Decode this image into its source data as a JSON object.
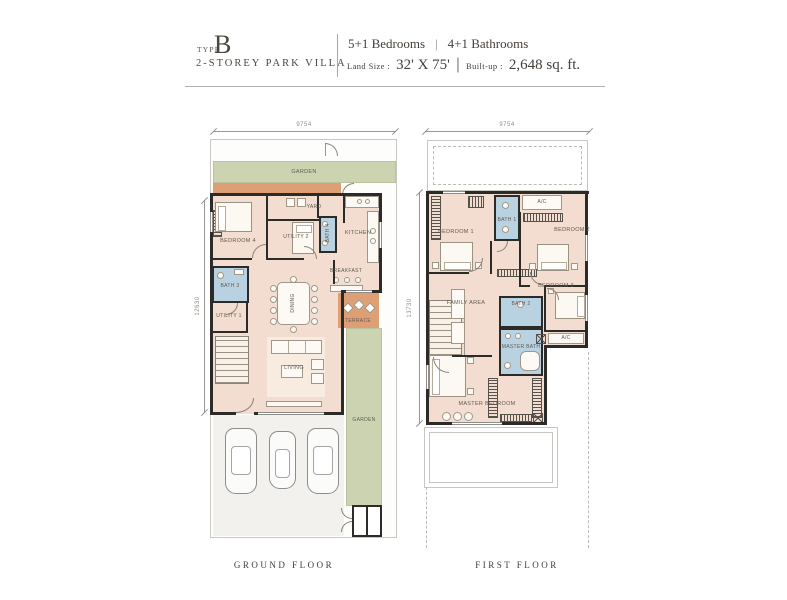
{
  "header": {
    "type_label": "TYPE",
    "type_value": "B",
    "subtitle": "2-STOREY PARK VILLA",
    "bedrooms": "5+1 Bedrooms",
    "spec_divider": "|",
    "bathrooms": "4+1 Bathrooms",
    "land_size_label": "Land Size :",
    "land_size_value": "32' X 75'",
    "size_divider": "|",
    "built_up_label": "Built-up :",
    "built_up_value": "2,648 sq. ft."
  },
  "ground_floor": {
    "caption": "GROUND FLOOR",
    "width_dim": "9754",
    "height_dim": "12630",
    "rooms": {
      "garden_top": "GARDEN",
      "yard": "YARD",
      "bedroom4": "BEDROOM 4",
      "utility2": "UTILITY 2",
      "bath4": "BATH 4",
      "kitchen": "KITCHEN",
      "breakfast": "BREAKFAST",
      "bath3": "BATH 3",
      "utility1": "UTILITY 1",
      "dining": "DINING",
      "terrace": "TERRACE",
      "living": "LIVING",
      "garden_side": "GARDEN"
    }
  },
  "first_floor": {
    "caption": "FIRST FLOOR",
    "width_dim": "9754",
    "height_dim": "13730",
    "rooms": {
      "bedroom1": "BEDROOM 1",
      "bath1": "BATH 1",
      "ac_top": "A/C",
      "bedroom2": "BEDROOM 2",
      "family_area": "FAMILY AREA",
      "bedroom3": "BEDROOM 3",
      "bath2": "BATH 2",
      "master_bath": "MASTER BATH",
      "ac_side": "A/C",
      "master_bedroom": "MASTER BEDROOM"
    }
  },
  "colors": {
    "floor": "#f3ddd0",
    "garden": "#ccd3b1",
    "terrace": "#df9f75",
    "bathroom": "#b9d2e2",
    "wall": "#2d2b28"
  }
}
